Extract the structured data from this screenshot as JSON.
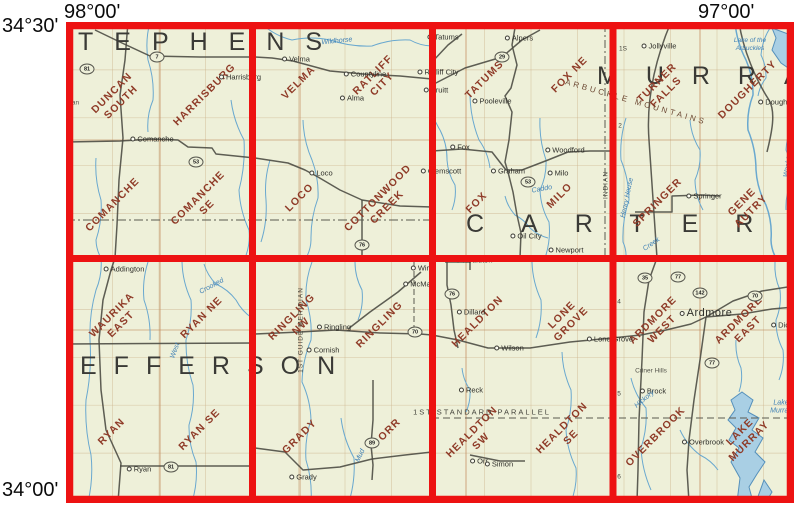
{
  "corner_labels": {
    "top_left": "98°00'",
    "top_right": "97°00'",
    "left_top": "34°30'",
    "left_bottom": "34°00'"
  },
  "colors": {
    "grid_red": "#ed1212",
    "map_bg": "#eef0d9",
    "quad_name": "#8f3b28",
    "road": "#4c4c44",
    "stream": "#69a8cf",
    "lake_fill": "#a9cfe4",
    "lake_edge": "#5590bb",
    "county_text": "#3a3a36",
    "township_grid": "#cdb58f"
  },
  "counties": [
    {
      "id": "stephens",
      "text": "TEPHENS",
      "x": 78,
      "y": 28,
      "ls": 21
    },
    {
      "id": "jefferson",
      "text": "EFFERSON",
      "x": 80,
      "y": 352,
      "ls": 17
    },
    {
      "id": "carter",
      "text": "CARTER",
      "x": 466,
      "y": 210,
      "ls": 37
    },
    {
      "id": "murray",
      "text": "MURRAY",
      "x": 597,
      "y": 62,
      "ls": 28
    }
  ],
  "quads": [
    {
      "name": "DUNCAN SOUTH",
      "lines": "DUNCAN\nSOUTH",
      "x": 117,
      "y": 98
    },
    {
      "name": "HARRISBURG",
      "lines": "HARRISBURG",
      "x": 205,
      "y": 95
    },
    {
      "name": "COMANCHE",
      "lines": "COMANCHE",
      "x": 113,
      "y": 205
    },
    {
      "name": "COMANCHE SE",
      "lines": "COMANCHE\nSE",
      "x": 203,
      "y": 203
    },
    {
      "name": "VELMA",
      "lines": "VELMA",
      "x": 299,
      "y": 83
    },
    {
      "name": "RATLIFF CITY",
      "lines": "RATLIFF\nCITY",
      "x": 378,
      "y": 80
    },
    {
      "name": "LOCO",
      "lines": "LOCO",
      "x": 300,
      "y": 198
    },
    {
      "name": "COTTONWOOD CREEK",
      "lines": "COTTONWOOD\nCREEK",
      "x": 383,
      "y": 203
    },
    {
      "name": "TATUMS",
      "lines": "TATUMS",
      "x": 485,
      "y": 80
    },
    {
      "name": "FOX NE",
      "lines": "FOX NE",
      "x": 570,
      "y": 75
    },
    {
      "name": "FOX",
      "lines": "FOX",
      "x": 477,
      "y": 203
    },
    {
      "name": "MILO",
      "lines": "MILO",
      "x": 560,
      "y": 196
    },
    {
      "name": "TURNER FALLS",
      "lines": "TURNER\nFALLS",
      "x": 662,
      "y": 88
    },
    {
      "name": "DOUGHERTY",
      "lines": "DOUGHERTY",
      "x": 748,
      "y": 90
    },
    {
      "name": "SPRINGER",
      "lines": "SPRINGER",
      "x": 658,
      "y": 203
    },
    {
      "name": "GENE AUTRY",
      "lines": "GENE\nAUTRY",
      "x": 747,
      "y": 207
    },
    {
      "name": "WAURIKA EAST",
      "lines": "WAURIKA\nEAST",
      "x": 117,
      "y": 320
    },
    {
      "name": "RYAN NE",
      "lines": "RYAN NE",
      "x": 202,
      "y": 318
    },
    {
      "name": "RYAN",
      "lines": "RYAN",
      "x": 112,
      "y": 432
    },
    {
      "name": "RYAN SE",
      "lines": "RYAN SE",
      "x": 200,
      "y": 430
    },
    {
      "name": "RINGLING NW",
      "lines": "RINGLING\nNW",
      "x": 297,
      "y": 322
    },
    {
      "name": "RINGLING",
      "lines": "RINGLING",
      "x": 380,
      "y": 325
    },
    {
      "name": "GRADY",
      "lines": "GRADY",
      "x": 300,
      "y": 437
    },
    {
      "name": "ORR",
      "lines": "ORR",
      "x": 390,
      "y": 430
    },
    {
      "name": "HEALDTON",
      "lines": "HEALDTON",
      "x": 478,
      "y": 322
    },
    {
      "name": "LONE GROVE",
      "lines": "LONE\nGROVE",
      "x": 567,
      "y": 320
    },
    {
      "name": "HEALDTON SW",
      "lines": "HEALDTON\nSW",
      "x": 477,
      "y": 437
    },
    {
      "name": "HEALDTON SE",
      "lines": "HEALDTON\nSE",
      "x": 567,
      "y": 433
    },
    {
      "name": "ARDMORE WEST",
      "lines": "ARDMORE\nWEST",
      "x": 658,
      "y": 325
    },
    {
      "name": "ARDMORE EAST",
      "lines": "ARDMORE\nEAST",
      "x": 744,
      "y": 325
    },
    {
      "name": "OVERBROOK",
      "lines": "OVERBROOK",
      "x": 656,
      "y": 437
    },
    {
      "name": "LAKE MURRAY",
      "lines": "LAKE\nMURRAY",
      "x": 745,
      "y": 437
    }
  ],
  "towns": [
    {
      "t": "Comanche",
      "x": 152,
      "y": 139
    },
    {
      "t": "Harrisburg",
      "x": 240,
      "y": 77
    },
    {
      "t": "dian",
      "x": 73,
      "y": 103,
      "dot": false,
      "small": true
    },
    {
      "t": "Velma",
      "x": 296,
      "y": 59
    },
    {
      "t": "Countyline",
      "x": 365,
      "y": 74
    },
    {
      "t": "Alma",
      "x": 352,
      "y": 98
    },
    {
      "t": "Loco",
      "x": 321,
      "y": 173
    },
    {
      "t": "Clemscott",
      "x": 441,
      "y": 171
    },
    {
      "t": "Tatums",
      "x": 443,
      "y": 37
    },
    {
      "t": "Alpers",
      "x": 519,
      "y": 38
    },
    {
      "t": "Ratliff City",
      "x": 438,
      "y": 72
    },
    {
      "t": "Pruitt",
      "x": 436,
      "y": 90
    },
    {
      "t": "Pooleville",
      "x": 492,
      "y": 101
    },
    {
      "t": "Fox",
      "x": 460,
      "y": 147
    },
    {
      "t": "Graham",
      "x": 508,
      "y": 171
    },
    {
      "t": "Woodford",
      "x": 565,
      "y": 150
    },
    {
      "t": "Milo",
      "x": 558,
      "y": 173
    },
    {
      "t": "Oil City",
      "x": 526,
      "y": 236
    },
    {
      "t": "Newport",
      "x": 566,
      "y": 250
    },
    {
      "t": "Jollyville",
      "x": 659,
      "y": 46
    },
    {
      "t": "Dougherty",
      "x": 779,
      "y": 102
    },
    {
      "t": "Springer",
      "x": 704,
      "y": 196
    },
    {
      "t": "Addington",
      "x": 124,
      "y": 269
    },
    {
      "t": "Wirt",
      "x": 421,
      "y": 268
    },
    {
      "t": "McMan",
      "x": 419,
      "y": 284
    },
    {
      "t": "Ringling",
      "x": 334,
      "y": 327
    },
    {
      "t": "Cornish",
      "x": 323,
      "y": 350
    },
    {
      "t": "Ryan",
      "x": 139,
      "y": 469
    },
    {
      "t": "Grady",
      "x": 303,
      "y": 477
    },
    {
      "t": "Orr",
      "x": 479,
      "y": 461
    },
    {
      "t": "Healdton",
      "x": 474,
      "y": 260
    },
    {
      "t": "Dillard",
      "x": 471,
      "y": 312
    },
    {
      "t": "Wilson",
      "x": 509,
      "y": 348
    },
    {
      "t": "Reck",
      "x": 471,
      "y": 390
    },
    {
      "t": "Simon",
      "x": 499,
      "y": 464
    },
    {
      "t": "Lone Grove",
      "x": 610,
      "y": 339
    },
    {
      "t": "Ardmore",
      "x": 706,
      "y": 313,
      "big": true
    },
    {
      "t": "Dickson",
      "x": 788,
      "y": 325
    },
    {
      "t": "Brock",
      "x": 653,
      "y": 391
    },
    {
      "t": "Overbrook",
      "x": 703,
      "y": 442
    },
    {
      "t": "Criner Hills",
      "x": 651,
      "y": 371,
      "dot": false,
      "small": true
    }
  ],
  "water_labels": [
    {
      "t": "Wildhorse",
      "x": 337,
      "y": 42,
      "rot": -6
    },
    {
      "t": "Lake of the\nArbuckles",
      "x": 750,
      "y": 45,
      "rot": 0,
      "fs": 6.5
    },
    {
      "t": "Henry House",
      "x": 628,
      "y": 198,
      "rot": -78
    },
    {
      "t": "Creek",
      "x": 652,
      "y": 245,
      "rot": -35
    },
    {
      "t": "Caddo",
      "x": 542,
      "y": 190,
      "rot": -10
    },
    {
      "t": "Crooked",
      "x": 212,
      "y": 287,
      "rot": -28
    },
    {
      "t": "West",
      "x": 176,
      "y": 351,
      "rot": -70
    },
    {
      "t": "Mud",
      "x": 361,
      "y": 456,
      "rot": -65
    },
    {
      "t": "Hickory",
      "x": 645,
      "y": 400,
      "rot": -40
    },
    {
      "t": "Washita",
      "x": 789,
      "y": 165,
      "rot": -80
    },
    {
      "t": "Lake\nMurray",
      "x": 781,
      "y": 408,
      "rot": 0
    }
  ],
  "misc_labels": [
    {
      "t": "ARBUCKLE MOUNTAINS",
      "x": 636,
      "y": 102,
      "rot": 16,
      "fs": 8,
      "ls": 3,
      "c": "#6d4a35"
    },
    {
      "t": "1ST STANDARD PARALLEL",
      "x": 482,
      "y": 412,
      "rot": 0,
      "fs": 7.5,
      "ls": 2
    },
    {
      "t": "1ST GUIDE MERIDIAN",
      "x": 301,
      "y": 330,
      "rot": -90,
      "fs": 6.5,
      "ls": 1
    },
    {
      "t": "INDIAN",
      "x": 606,
      "y": 185,
      "rot": -90,
      "fs": 6.5,
      "ls": 1
    },
    {
      "t": "1S",
      "x": 623,
      "y": 49,
      "fs": 6.5
    },
    {
      "t": "2",
      "x": 620,
      "y": 126,
      "fs": 6.5
    },
    {
      "t": "4",
      "x": 619,
      "y": 302,
      "fs": 6.5
    },
    {
      "t": "5",
      "x": 619,
      "y": 394,
      "fs": 6.5
    },
    {
      "t": "6",
      "x": 619,
      "y": 477,
      "fs": 6.5
    }
  ],
  "highway_shields": [
    {
      "num": "81",
      "x": 87,
      "y": 69
    },
    {
      "num": "7",
      "x": 157,
      "y": 57
    },
    {
      "num": "53",
      "x": 196,
      "y": 162
    },
    {
      "num": "29",
      "x": 502,
      "y": 57
    },
    {
      "num": "53",
      "x": 528,
      "y": 182
    },
    {
      "num": "76",
      "x": 362,
      "y": 245
    },
    {
      "num": "70",
      "x": 415,
      "y": 332
    },
    {
      "num": "81",
      "x": 171,
      "y": 467
    },
    {
      "num": "89",
      "x": 372,
      "y": 443
    },
    {
      "num": "76",
      "x": 452,
      "y": 294
    },
    {
      "num": "35",
      "x": 645,
      "y": 278
    },
    {
      "num": "77",
      "x": 678,
      "y": 277
    },
    {
      "num": "142",
      "x": 700,
      "y": 293
    },
    {
      "num": "70",
      "x": 755,
      "y": 296
    },
    {
      "num": "77",
      "x": 712,
      "y": 363
    }
  ]
}
